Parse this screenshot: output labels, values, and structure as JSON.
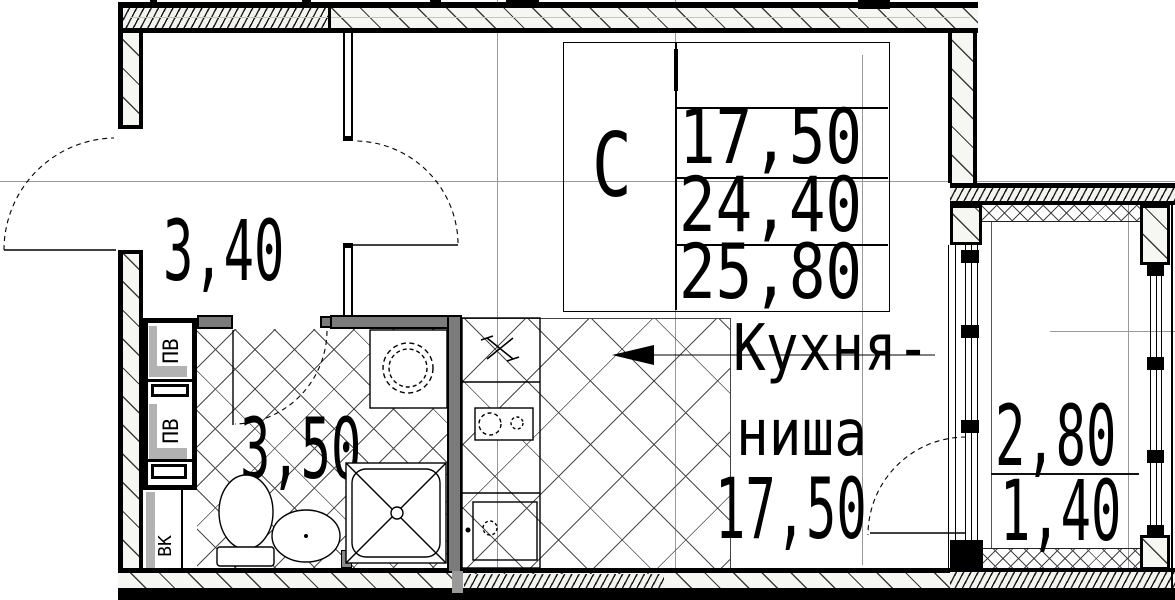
{
  "title": "studio-apartment-floor-plan",
  "stamp": {
    "letter": "С",
    "area_living": "17,50",
    "area_apartment": "24,40",
    "area_total": "25,80"
  },
  "rooms": {
    "hallway": {
      "area": "3,40"
    },
    "bathroom": {
      "area": "3,50"
    },
    "kitchen": {
      "name_line1": "Кухня-",
      "name_line2": "ниша",
      "area": "17,50"
    },
    "balcony": {
      "area_full": "2,80",
      "area_reduced": "1,40"
    }
  },
  "shafts": {
    "vent_top": "ПВ",
    "vent_bottom": "ПВ",
    "water": "ВК"
  },
  "colors": {
    "line": "#000000",
    "wall_gray": "#7b7b7b",
    "axis": "#999999",
    "paper": "#ffffff"
  }
}
